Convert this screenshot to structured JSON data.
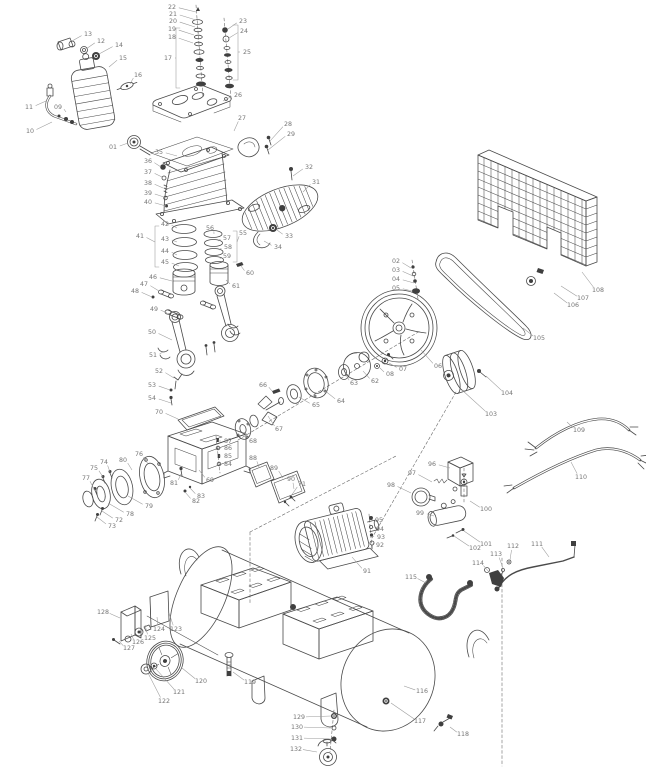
{
  "figure": {
    "background": "#ffffff",
    "line_color": "#4a4a4a",
    "label_color": "#757575",
    "leader_color": "#9a9a9a"
  },
  "callouts": [
    {
      "id": "01",
      "x": 113,
      "y": 147,
      "ex": 128,
      "ey": 143
    },
    {
      "id": "02",
      "x": 396,
      "y": 261,
      "ex": 411,
      "ey": 268
    },
    {
      "id": "03",
      "x": 396,
      "y": 270,
      "ex": 413,
      "ey": 276
    },
    {
      "id": "04",
      "x": 396,
      "y": 279,
      "ex": 414,
      "ey": 283
    },
    {
      "id": "05",
      "x": 396,
      "y": 288,
      "ex": 412,
      "ey": 291
    },
    {
      "id": "06",
      "x": 438,
      "y": 366,
      "ex": 421,
      "ey": 350
    },
    {
      "id": "07",
      "x": 403,
      "y": 369,
      "ex": 389,
      "ey": 363
    },
    {
      "id": "08",
      "x": 390,
      "y": 374,
      "ex": 380,
      "ey": 368
    },
    {
      "id": "09",
      "x": 58,
      "y": 107,
      "ex": 66,
      "ey": 112
    },
    {
      "id": "10",
      "x": 30,
      "y": 131,
      "ex": 52,
      "ey": 122
    },
    {
      "id": "11",
      "x": 29,
      "y": 107,
      "ex": 46,
      "ey": 101
    },
    {
      "id": "12",
      "x": 101,
      "y": 41,
      "ex": 86,
      "ey": 49
    },
    {
      "id": "13",
      "x": 88,
      "y": 34,
      "ex": 72,
      "ey": 41
    },
    {
      "id": "14",
      "x": 119,
      "y": 45,
      "ex": 99,
      "ey": 54
    },
    {
      "id": "15",
      "x": 123,
      "y": 58,
      "ex": 109,
      "ey": 67
    },
    {
      "id": "16",
      "x": 138,
      "y": 75,
      "ex": 130,
      "ey": 84
    },
    {
      "id": "17",
      "x": 168,
      "y": 58,
      "ex": 176,
      "ey": 58
    },
    {
      "id": "18",
      "x": 172,
      "y": 37,
      "ex": 193,
      "ey": 43
    },
    {
      "id": "19",
      "x": 172,
      "y": 29,
      "ex": 194,
      "ey": 35
    },
    {
      "id": "20",
      "x": 173,
      "y": 21,
      "ex": 195,
      "ey": 27
    },
    {
      "id": "21",
      "x": 173,
      "y": 14,
      "ex": 196,
      "ey": 20
    },
    {
      "id": "22",
      "x": 172,
      "y": 7,
      "ex": 196,
      "ey": 12
    },
    {
      "id": "23",
      "x": 243,
      "y": 21,
      "ex": 228,
      "ey": 29
    },
    {
      "id": "24",
      "x": 244,
      "y": 31,
      "ex": 229,
      "ey": 38
    },
    {
      "id": "25",
      "x": 247,
      "y": 52,
      "ex": 238,
      "ey": 52
    },
    {
      "id": "26",
      "x": 238,
      "y": 95,
      "ex": 223,
      "ey": 101
    },
    {
      "id": "27",
      "x": 242,
      "y": 118,
      "ex": 234,
      "ey": 131
    },
    {
      "id": "28",
      "x": 288,
      "y": 124,
      "ex": 270,
      "ey": 141
    },
    {
      "id": "29",
      "x": 291,
      "y": 134,
      "ex": 268,
      "ey": 150
    },
    {
      "id": "31",
      "x": 316,
      "y": 182,
      "ex": 303,
      "ey": 192
    },
    {
      "id": "32",
      "x": 309,
      "y": 167,
      "ex": 293,
      "ey": 176
    },
    {
      "id": "33",
      "x": 289,
      "y": 236,
      "ex": 277,
      "ey": 230
    },
    {
      "id": "34",
      "x": 278,
      "y": 247,
      "ex": 264,
      "ey": 241
    },
    {
      "id": "35",
      "x": 159,
      "y": 152,
      "ex": 177,
      "ey": 156
    },
    {
      "id": "36",
      "x": 148,
      "y": 161,
      "ex": 161,
      "ey": 167
    },
    {
      "id": "37",
      "x": 148,
      "y": 172,
      "ex": 162,
      "ey": 177
    },
    {
      "id": "38",
      "x": 148,
      "y": 183,
      "ex": 163,
      "ey": 188
    },
    {
      "id": "39",
      "x": 148,
      "y": 193,
      "ex": 164,
      "ey": 197
    },
    {
      "id": "40",
      "x": 148,
      "y": 202,
      "ex": 166,
      "ey": 206
    },
    {
      "id": "41",
      "x": 140,
      "y": 236,
      "ex": 155,
      "ey": 242
    },
    {
      "id": "42",
      "x": 165,
      "y": 224,
      "ex": 177,
      "ey": 228
    },
    {
      "id": "43",
      "x": 165,
      "y": 239,
      "ex": 177,
      "ey": 242
    },
    {
      "id": "44",
      "x": 165,
      "y": 251,
      "ex": 177,
      "ey": 255
    },
    {
      "id": "45",
      "x": 165,
      "y": 262,
      "ex": 179,
      "ey": 266
    },
    {
      "id": "46",
      "x": 153,
      "y": 277,
      "ex": 172,
      "ey": 281
    },
    {
      "id": "47",
      "x": 144,
      "y": 284,
      "ex": 159,
      "ey": 291
    },
    {
      "id": "48",
      "x": 135,
      "y": 291,
      "ex": 152,
      "ey": 297
    },
    {
      "id": "49",
      "x": 154,
      "y": 309,
      "ex": 167,
      "ey": 313
    },
    {
      "id": "50",
      "x": 152,
      "y": 332,
      "ex": 172,
      "ey": 340
    },
    {
      "id": "51",
      "x": 153,
      "y": 355,
      "ex": 163,
      "ey": 352
    },
    {
      "id": "52",
      "x": 159,
      "y": 371,
      "ex": 174,
      "ey": 378
    },
    {
      "id": "53",
      "x": 152,
      "y": 385,
      "ex": 170,
      "ey": 390
    },
    {
      "id": "54",
      "x": 152,
      "y": 398,
      "ex": 171,
      "ey": 403
    },
    {
      "id": "55",
      "x": 243,
      "y": 233,
      "ex": 237,
      "ey": 242
    },
    {
      "id": "56",
      "x": 210,
      "y": 228,
      "ex": 214,
      "ey": 234
    },
    {
      "id": "57",
      "x": 227,
      "y": 238,
      "ex": 218,
      "ey": 241
    },
    {
      "id": "58",
      "x": 228,
      "y": 247,
      "ex": 219,
      "ey": 250
    },
    {
      "id": "59",
      "x": 227,
      "y": 256,
      "ex": 220,
      "ey": 259
    },
    {
      "id": "60",
      "x": 250,
      "y": 273,
      "ex": 241,
      "ey": 266
    },
    {
      "id": "61",
      "x": 236,
      "y": 286,
      "ex": 226,
      "ey": 280
    },
    {
      "id": "62",
      "x": 375,
      "y": 381,
      "ex": 363,
      "ey": 371
    },
    {
      "id": "63",
      "x": 354,
      "y": 383,
      "ex": 346,
      "ey": 375
    },
    {
      "id": "64",
      "x": 341,
      "y": 401,
      "ex": 324,
      "ey": 390
    },
    {
      "id": "65",
      "x": 316,
      "y": 405,
      "ex": 299,
      "ey": 397
    },
    {
      "id": "66",
      "x": 263,
      "y": 385,
      "ex": 272,
      "ey": 391
    },
    {
      "id": "67",
      "x": 279,
      "y": 429,
      "ex": 268,
      "ey": 416
    },
    {
      "id": "68",
      "x": 253,
      "y": 441,
      "ex": 244,
      "ey": 432
    },
    {
      "id": "69",
      "x": 210,
      "y": 480,
      "ex": 199,
      "ey": 470
    },
    {
      "id": "70",
      "x": 159,
      "y": 412,
      "ex": 178,
      "ey": 419
    },
    {
      "id": "71",
      "x": 302,
      "y": 484,
      "ex": 291,
      "ey": 496
    },
    {
      "id": "72",
      "x": 119,
      "y": 520,
      "ex": 102,
      "ey": 511
    },
    {
      "id": "73",
      "x": 112,
      "y": 526,
      "ex": 97,
      "ey": 517
    },
    {
      "id": "74",
      "x": 104,
      "y": 462,
      "ex": 110,
      "ey": 472
    },
    {
      "id": "75",
      "x": 94,
      "y": 468,
      "ex": 103,
      "ey": 477
    },
    {
      "id": "76",
      "x": 139,
      "y": 454,
      "ex": 148,
      "ey": 464
    },
    {
      "id": "77",
      "x": 86,
      "y": 478,
      "ex": 95,
      "ey": 491
    },
    {
      "id": "78",
      "x": 130,
      "y": 514,
      "ex": 108,
      "ey": 503
    },
    {
      "id": "79",
      "x": 149,
      "y": 506,
      "ex": 128,
      "ey": 496
    },
    {
      "id": "80",
      "x": 123,
      "y": 460,
      "ex": 132,
      "ey": 470
    },
    {
      "id": "81",
      "x": 174,
      "y": 483,
      "ex": 181,
      "ey": 474
    },
    {
      "id": "82",
      "x": 196,
      "y": 501,
      "ex": 185,
      "ey": 492
    },
    {
      "id": "83",
      "x": 201,
      "y": 496,
      "ex": 190,
      "ey": 488
    },
    {
      "id": "84",
      "x": 228,
      "y": 464,
      "ex": 220,
      "ey": 464
    },
    {
      "id": "85",
      "x": 228,
      "y": 456,
      "ex": 219,
      "ey": 456
    },
    {
      "id": "86",
      "x": 228,
      "y": 448,
      "ex": 219,
      "ey": 448
    },
    {
      "id": "87",
      "x": 228,
      "y": 441,
      "ex": 218,
      "ey": 441
    },
    {
      "id": "88",
      "x": 253,
      "y": 458,
      "ex": 259,
      "ey": 467
    },
    {
      "id": "89",
      "x": 274,
      "y": 468,
      "ex": 283,
      "ey": 478
    },
    {
      "id": "90",
      "x": 291,
      "y": 479,
      "ex": 294,
      "ey": 489
    },
    {
      "id": "91",
      "x": 367,
      "y": 571,
      "ex": 352,
      "ey": 557
    },
    {
      "id": "92",
      "x": 380,
      "y": 545,
      "ex": 373,
      "ey": 543
    },
    {
      "id": "93",
      "x": 381,
      "y": 537,
      "ex": 373,
      "ey": 536
    },
    {
      "id": "94",
      "x": 380,
      "y": 529,
      "ex": 373,
      "ey": 527
    },
    {
      "id": "95",
      "x": 379,
      "y": 520,
      "ex": 373,
      "ey": 518
    },
    {
      "id": "96",
      "x": 432,
      "y": 464,
      "ex": 450,
      "ey": 468
    },
    {
      "id": "97",
      "x": 412,
      "y": 473,
      "ex": 432,
      "ey": 482
    },
    {
      "id": "98",
      "x": 391,
      "y": 485,
      "ex": 411,
      "ey": 493
    },
    {
      "id": "99",
      "x": 420,
      "y": 513,
      "ex": 434,
      "ey": 516
    },
    {
      "id": "100",
      "x": 486,
      "y": 509,
      "ex": 470,
      "ey": 501
    },
    {
      "id": "101",
      "x": 486,
      "y": 544,
      "ex": 464,
      "ey": 531
    },
    {
      "id": "102",
      "x": 475,
      "y": 548,
      "ex": 454,
      "ey": 536
    },
    {
      "id": "103",
      "x": 491,
      "y": 414,
      "ex": 462,
      "ey": 390
    },
    {
      "id": "104",
      "x": 507,
      "y": 393,
      "ex": 486,
      "ey": 376
    },
    {
      "id": "105",
      "x": 539,
      "y": 338,
      "ex": 523,
      "ey": 328
    },
    {
      "id": "106",
      "x": 573,
      "y": 305,
      "ex": 554,
      "ey": 293
    },
    {
      "id": "107",
      "x": 583,
      "y": 298,
      "ex": 561,
      "ey": 286
    },
    {
      "id": "108",
      "x": 598,
      "y": 290,
      "ex": 582,
      "ey": 272
    },
    {
      "id": "109",
      "x": 579,
      "y": 430,
      "ex": 567,
      "ey": 422
    },
    {
      "id": "110",
      "x": 581,
      "y": 477,
      "ex": 571,
      "ey": 462
    },
    {
      "id": "111",
      "x": 537,
      "y": 544,
      "ex": 549,
      "ey": 557
    },
    {
      "id": "112",
      "x": 513,
      "y": 546,
      "ex": 510,
      "ey": 560
    },
    {
      "id": "113",
      "x": 496,
      "y": 554,
      "ex": 503,
      "ey": 568
    },
    {
      "id": "114",
      "x": 478,
      "y": 563,
      "ex": 489,
      "ey": 572
    },
    {
      "id": "115",
      "x": 411,
      "y": 577,
      "ex": 426,
      "ey": 583
    },
    {
      "id": "116",
      "x": 422,
      "y": 691,
      "ex": 404,
      "ey": 686
    },
    {
      "id": "117",
      "x": 420,
      "y": 721,
      "ex": 391,
      "ey": 703
    },
    {
      "id": "118",
      "x": 463,
      "y": 734,
      "ex": 450,
      "ey": 727
    },
    {
      "id": "119",
      "x": 250,
      "y": 682,
      "ex": 233,
      "ey": 672
    },
    {
      "id": "120",
      "x": 201,
      "y": 681,
      "ex": 182,
      "ey": 668
    },
    {
      "id": "121",
      "x": 179,
      "y": 692,
      "ex": 156,
      "ey": 669
    },
    {
      "id": "122",
      "x": 164,
      "y": 701,
      "ex": 148,
      "ey": 673
    },
    {
      "id": "123",
      "x": 176,
      "y": 629,
      "ex": 169,
      "ey": 613
    },
    {
      "id": "124",
      "x": 159,
      "y": 629,
      "ex": 157,
      "ey": 617
    },
    {
      "id": "125",
      "x": 150,
      "y": 638,
      "ex": 145,
      "ey": 625
    },
    {
      "id": "126",
      "x": 138,
      "y": 642,
      "ex": 131,
      "ey": 634
    },
    {
      "id": "127",
      "x": 129,
      "y": 648,
      "ex": 119,
      "ey": 641
    },
    {
      "id": "128",
      "x": 103,
      "y": 612,
      "ex": 120,
      "ey": 618
    },
    {
      "id": "129",
      "x": 299,
      "y": 717,
      "ex": 331,
      "ey": 716
    },
    {
      "id": "130",
      "x": 297,
      "y": 727,
      "ex": 331,
      "ey": 728
    },
    {
      "id": "131",
      "x": 297,
      "y": 738,
      "ex": 331,
      "ey": 739
    },
    {
      "id": "132",
      "x": 296,
      "y": 749,
      "ex": 317,
      "ey": 752
    }
  ]
}
